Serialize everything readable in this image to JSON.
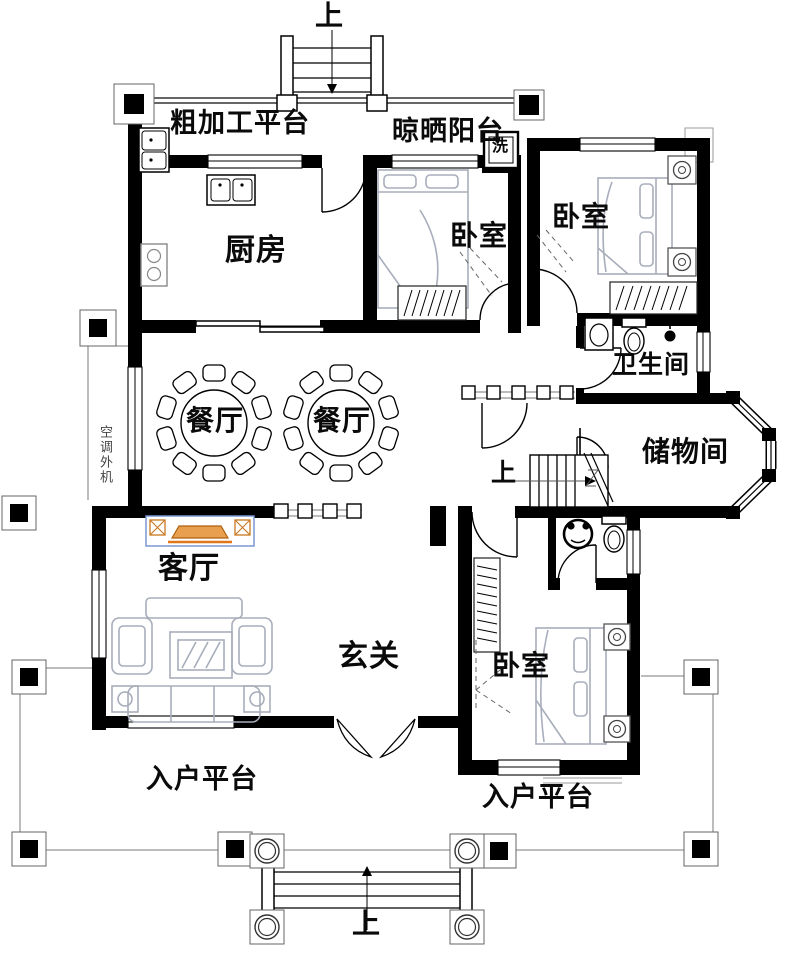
{
  "plan": {
    "stairs_top_label": "上",
    "stairs_middle_label": "上",
    "stairs_bottom_label": "上",
    "rough_work_platform": "粗加工平台",
    "drying_balcony": "晾晒阳台",
    "washer": "洗",
    "kitchen": "厨房",
    "bedroom_top_middle": "卧室",
    "bedroom_top_right": "卧室",
    "bathroom": "卫生间",
    "dining_left": "餐厅",
    "dining_right": "餐厅",
    "storage_room": "储物间",
    "ac_outdoor_unit": "空调外机",
    "living_room": "客厅",
    "entrance_hall": "玄关",
    "bedroom_bottom": "卧室",
    "entry_platform_left": "入户平台",
    "entry_platform_right": "入户平台"
  },
  "colors": {
    "wall": "#000000",
    "furniture_gray": "#a8adbb",
    "tv_accent_orange": "#e07818",
    "tv_outline_blue": "#7a96d0",
    "platform_line": "#787878"
  }
}
